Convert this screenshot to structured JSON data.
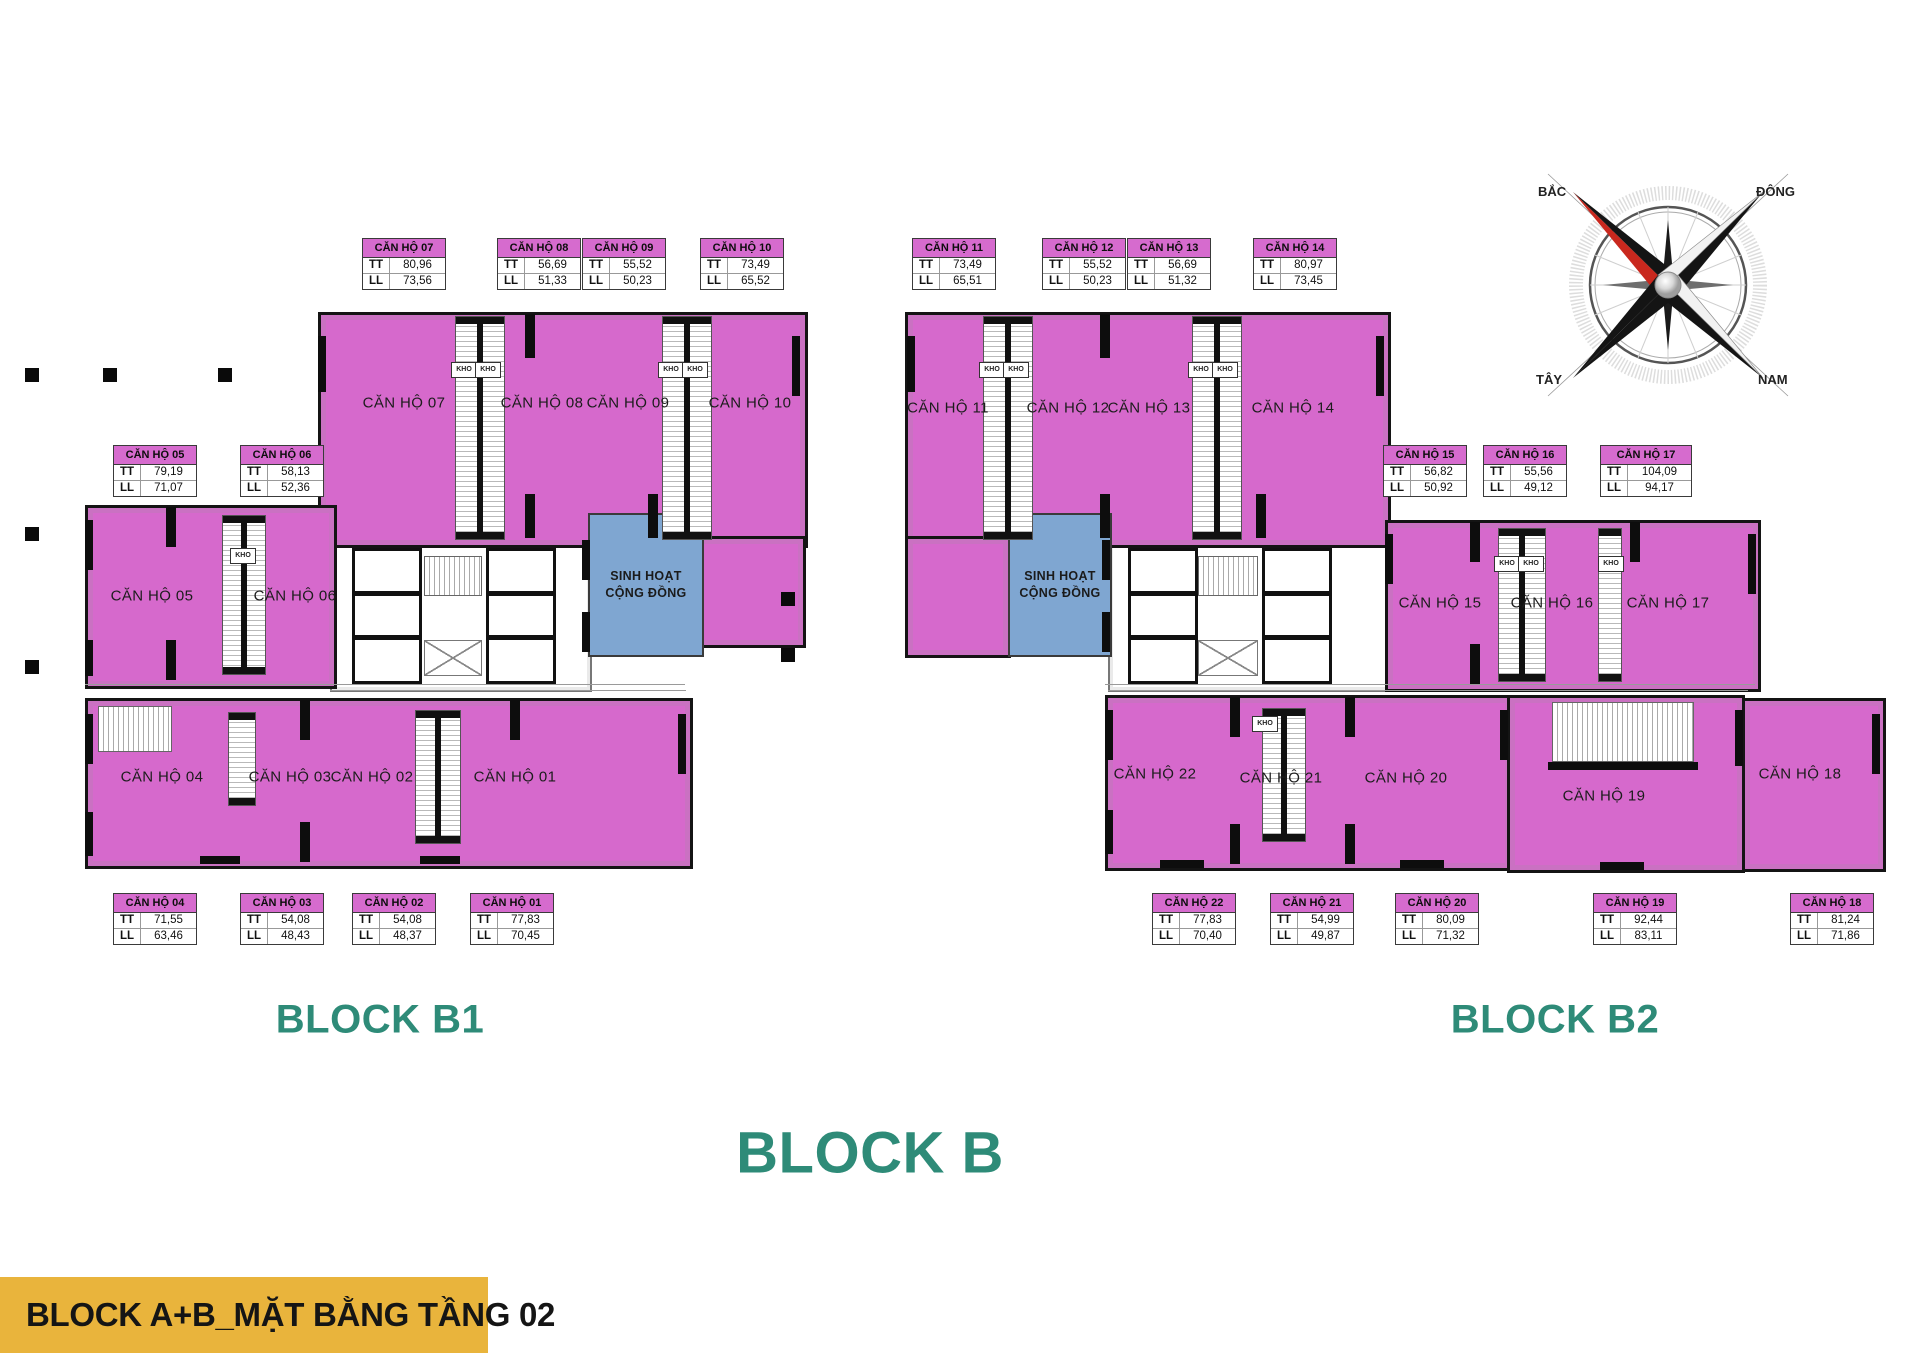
{
  "banner": {
    "text": "BLOCK A+B_MẶT BẰNG TẦNG 02"
  },
  "titles": {
    "block_b1": "BLOCK B1",
    "block_b2": "BLOCK B2",
    "block_b": "BLOCK B"
  },
  "colors": {
    "unit_fill": "#D669CC",
    "community_fill": "#7FA6D1",
    "table_header_bg": "#D66BCE",
    "title_teal": "#2E8B78",
    "banner_yellow": "#E9B43C",
    "needle_red": "#C9281E"
  },
  "compass": {
    "north": "BẮC",
    "east": "ĐÔNG",
    "west": "TÂY",
    "south": "NAM"
  },
  "community_room": {
    "line1": "SINH HOẠT",
    "line2": "CỘNG ĐỒNG"
  },
  "kho_label": "KHO",
  "area_table": {
    "row1_key": "TT",
    "row2_key": "LL"
  },
  "units": [
    {
      "id": "01",
      "name": "CĂN HỘ 01",
      "tt": "77,83",
      "ll": "70,45"
    },
    {
      "id": "02",
      "name": "CĂN HỘ 02",
      "tt": "54,08",
      "ll": "48,37"
    },
    {
      "id": "03",
      "name": "CĂN HỘ 03",
      "tt": "54,08",
      "ll": "48,43"
    },
    {
      "id": "04",
      "name": "CĂN HỘ 04",
      "tt": "71,55",
      "ll": "63,46"
    },
    {
      "id": "05",
      "name": "CĂN HỘ 05",
      "tt": "79,19",
      "ll": "71,07"
    },
    {
      "id": "06",
      "name": "CĂN HỘ 06",
      "tt": "58,13",
      "ll": "52,36"
    },
    {
      "id": "07",
      "name": "CĂN HỘ 07",
      "tt": "80,96",
      "ll": "73,56"
    },
    {
      "id": "08",
      "name": "CĂN HỘ 08",
      "tt": "56,69",
      "ll": "51,33"
    },
    {
      "id": "09",
      "name": "CĂN HỘ 09",
      "tt": "55,52",
      "ll": "50,23"
    },
    {
      "id": "10",
      "name": "CĂN HỘ 10",
      "tt": "73,49",
      "ll": "65,52"
    },
    {
      "id": "11",
      "name": "CĂN HỘ 11",
      "tt": "73,49",
      "ll": "65,51"
    },
    {
      "id": "12",
      "name": "CĂN HỘ 12",
      "tt": "55,52",
      "ll": "50,23"
    },
    {
      "id": "13",
      "name": "CĂN HỘ 13",
      "tt": "56,69",
      "ll": "51,32"
    },
    {
      "id": "14",
      "name": "CĂN HỘ 14",
      "tt": "80,97",
      "ll": "73,45"
    },
    {
      "id": "15",
      "name": "CĂN HỘ 15",
      "tt": "56,82",
      "ll": "50,92"
    },
    {
      "id": "16",
      "name": "CĂN HỘ 16",
      "tt": "55,56",
      "ll": "49,12"
    },
    {
      "id": "17",
      "name": "CĂN HỘ 17",
      "tt": "104,09",
      "ll": "94,17"
    },
    {
      "id": "18",
      "name": "CĂN HỘ 18",
      "tt": "81,24",
      "ll": "71,86"
    },
    {
      "id": "19",
      "name": "CĂN HỘ 19",
      "tt": "92,44",
      "ll": "83,11"
    },
    {
      "id": "20",
      "name": "CĂN HỘ 20",
      "tt": "80,09",
      "ll": "71,32"
    },
    {
      "id": "21",
      "name": "CĂN HỘ 21",
      "tt": "54,99",
      "ll": "49,87"
    },
    {
      "id": "22",
      "name": "CĂN HỘ 22",
      "tt": "77,83",
      "ll": "70,40"
    }
  ]
}
